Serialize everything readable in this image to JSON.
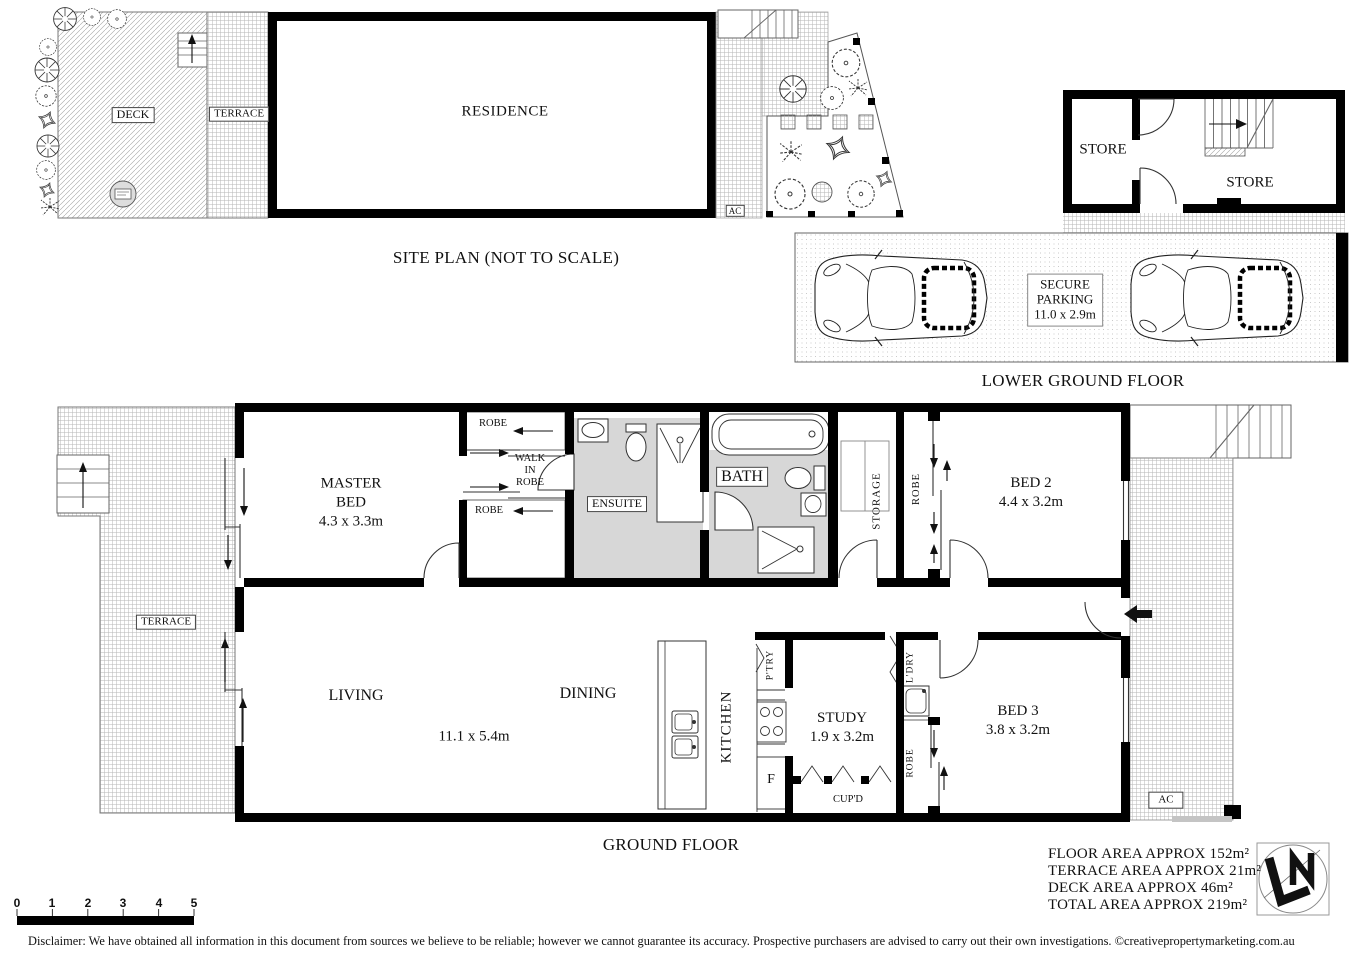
{
  "site_plan": {
    "title": "SITE PLAN (NOT TO SCALE)",
    "deck": "DECK",
    "terrace": "TERRACE",
    "residence": "RESIDENCE",
    "ac": "AC"
  },
  "lower_ground_floor": {
    "title": "LOWER GROUND FLOOR",
    "store_left": "STORE",
    "store_right": "STORE",
    "secure_parking_line1": "SECURE",
    "secure_parking_line2": "PARKING",
    "secure_parking_dims": "11.0 x 2.9m"
  },
  "ground_floor": {
    "title": "GROUND FLOOR",
    "terrace": "TERRACE",
    "master_bed_line1": "MASTER",
    "master_bed_line2": "BED",
    "master_bed_dims": "4.3 x 3.3m",
    "robe_top": "ROBE",
    "robe_bottom": "ROBE",
    "walk_in_robe_line1": "WALK",
    "walk_in_robe_line2": "IN",
    "walk_in_robe_line3": "ROBE",
    "ensuite": "ENSUITE",
    "bath": "BATH",
    "storage": "STORAGE",
    "robe_bed2": "ROBE",
    "bed2_name": "BED 2",
    "bed2_dims": "4.4 x 3.2m",
    "living": "LIVING",
    "dining": "DINING",
    "living_dining_dims": "11.1 x 5.4m",
    "kitchen": "KITCHEN",
    "pantry": "P'TRY",
    "fridge": "F",
    "study_name": "STUDY",
    "study_dims": "1.9 x 3.2m",
    "cupboard": "CUP'D",
    "laundry": "L'DRY",
    "robe_bed3": "ROBE",
    "bed3_name": "BED 3",
    "bed3_dims": "3.8 x 3.2m",
    "ac": "AC"
  },
  "summary": {
    "floor_area": "FLOOR AREA APPROX 152m²",
    "terrace_area": "TERRACE AREA APPROX 21m²",
    "deck_area": "DECK AREA APPROX 46m²",
    "total_area": "TOTAL AREA APPROX 219m²"
  },
  "scale_bar": {
    "t0": "0",
    "t1": "1",
    "t2": "2",
    "t3": "3",
    "t4": "4",
    "t5": "5"
  },
  "disclaimer": "Disclaimer: We have obtained all information in this document from sources we believe to be reliable; however we cannot guarantee its accuracy. Prospective purchasers are advised to carry out their own investigations. ©creativepropertymarketing.com.au"
}
